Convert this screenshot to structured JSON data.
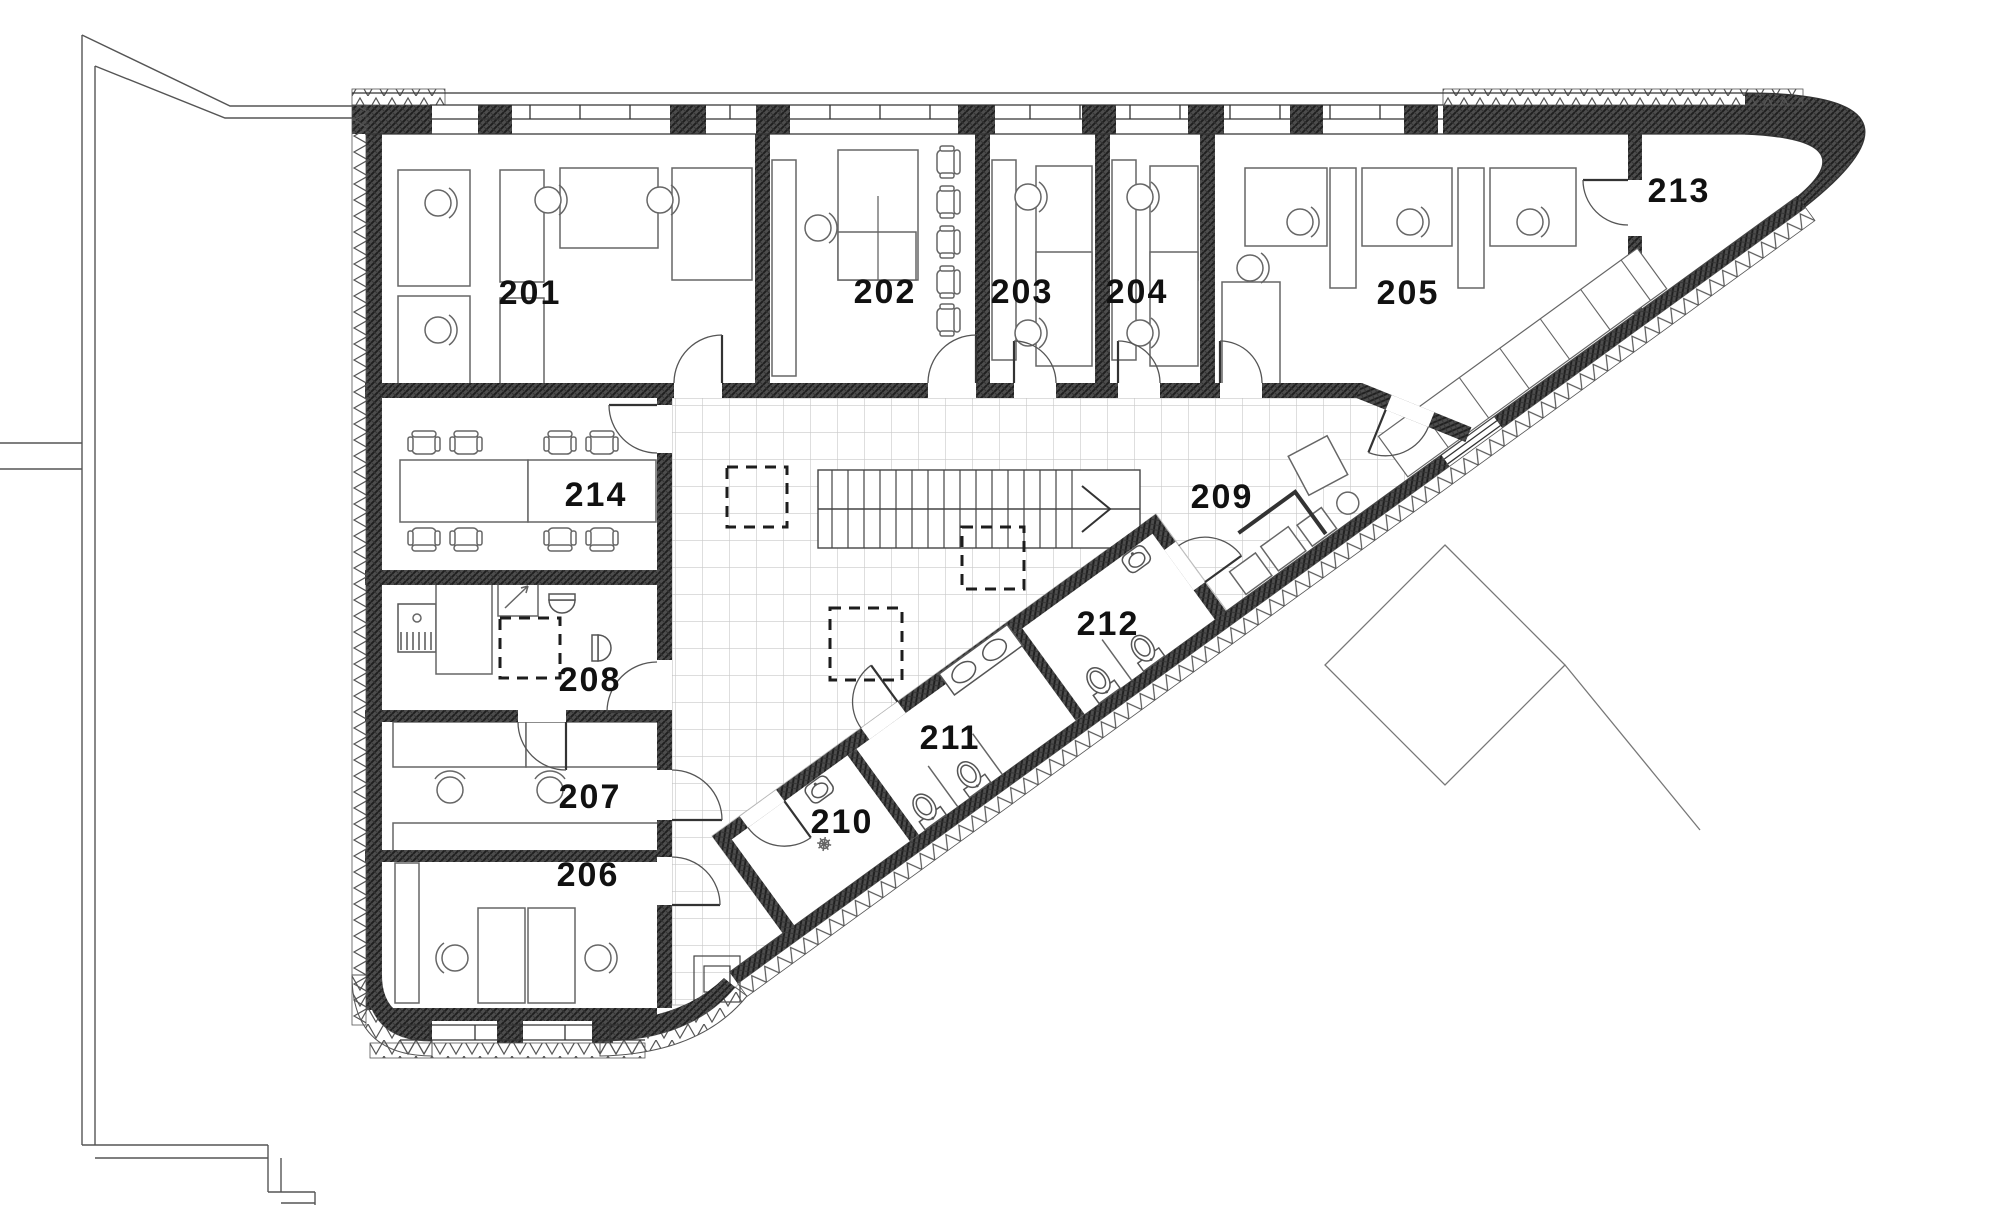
{
  "rooms": {
    "r201": "201",
    "r202": "202",
    "r203": "203",
    "r204": "204",
    "r205": "205",
    "r206": "206",
    "r207": "207",
    "r208": "208",
    "r209": "209",
    "r210": "210",
    "r211": "211",
    "r212": "212",
    "r213": "213",
    "r214": "214"
  },
  "colors": {
    "wall": "#4d4d4d",
    "tile_line": "#c9c9c9",
    "label": "#111111",
    "furniture_line": "#666666"
  }
}
